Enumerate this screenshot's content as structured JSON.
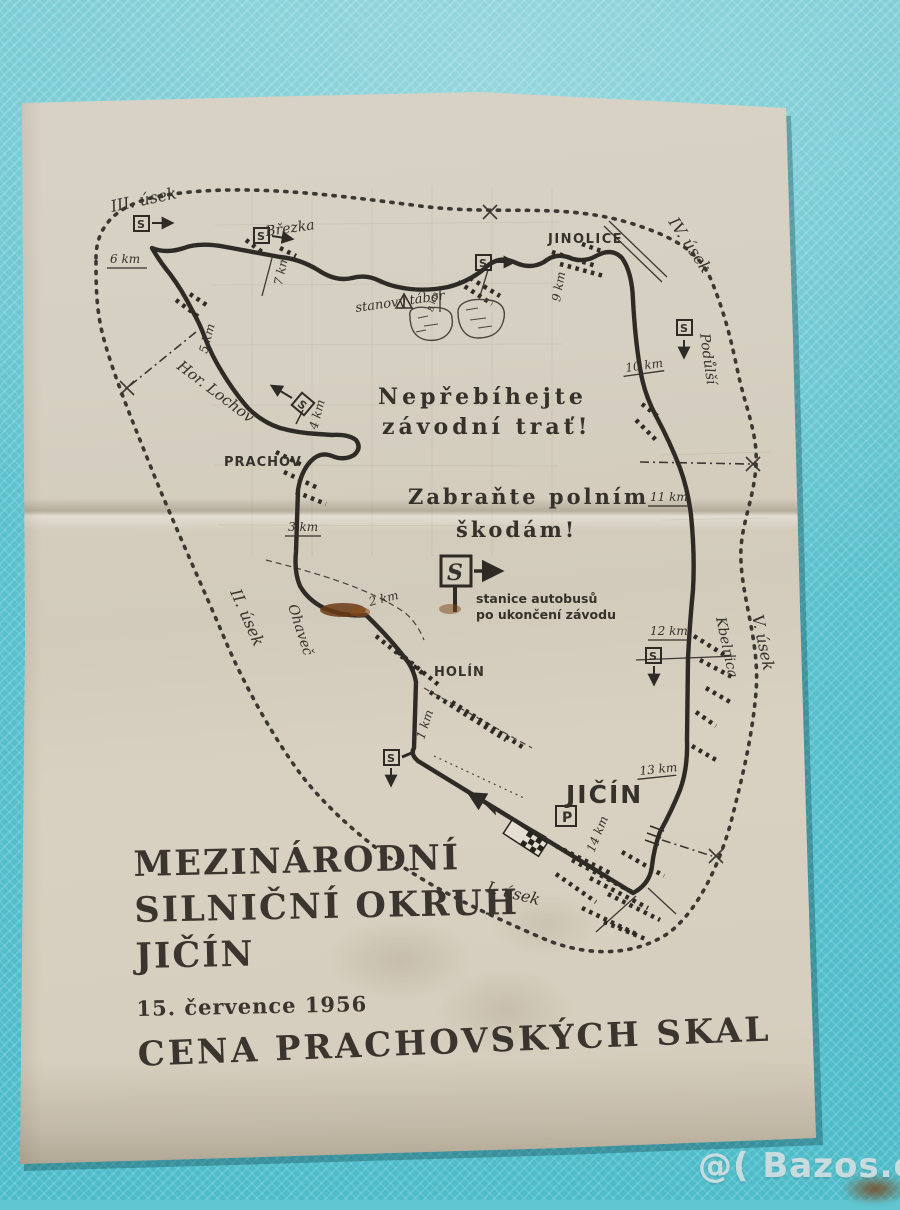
{
  "colors": {
    "background": "#5fc6d2",
    "paper": "#d5cfc1",
    "ink": "#2e2b26"
  },
  "map": {
    "labels": {
      "usek1": "I. úsek",
      "usek2": "II. úsek",
      "usek3": "III. úsek",
      "usek4": "IV. úsek",
      "usek5": "V. úsek",
      "brezka": "Březka",
      "jinolice": "JINOLICE",
      "podulsi": "Podůlší",
      "hor_lochov": "Hor. Lochov",
      "prachov": "PRACHOV",
      "ohavec": "Ohaveč",
      "holin": "HOLÍN",
      "kbelnica": "Kbelnica",
      "jicin": "JIČÍN",
      "camp": "stanový tábor"
    },
    "km": {
      "k1": "1 km",
      "k2": "2 km",
      "k3": "3 km",
      "k4": "4 km",
      "k5": "5 km",
      "k6": "6 km",
      "k7": "7 km",
      "k8": "8 km",
      "k9": "9 km",
      "k10": "10 km",
      "k11": "11 km",
      "k12": "12 km",
      "k13": "13 km",
      "k14": "14 km"
    },
    "warnings": {
      "w1a": "Nepřebíhejte",
      "w1b": "závodní trať!",
      "w2a": "Zabraňte polním",
      "w2b": "škodám!"
    },
    "signs": {
      "s": "S",
      "p": "P"
    },
    "bus_caption1": "stanice autobusů",
    "bus_caption2": "po ukončení závodu"
  },
  "footer": {
    "title_line1": "MEZINÁRODNÍ",
    "title_line2": "SILNIČNÍ OKRUH",
    "title_line3": "JIČÍN",
    "date": "15. července 1956",
    "subtitle": "CENA PRACHOVSKÝCH SKAL"
  },
  "watermark": "@( Bazos.cz"
}
